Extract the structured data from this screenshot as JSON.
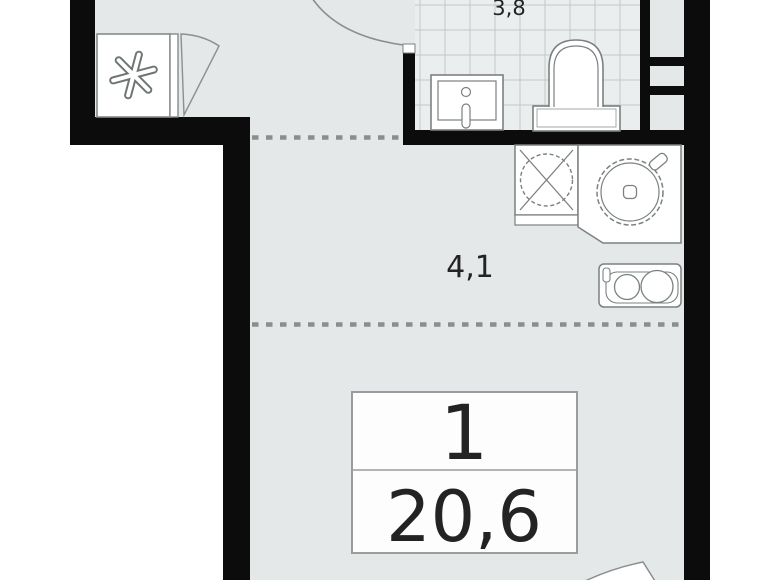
{
  "plan": {
    "bathroom": {
      "area_label": "3,8"
    },
    "hall": {
      "area_label": "4,1"
    },
    "summary": {
      "rooms_count": "1",
      "total_area": "20,6"
    },
    "icons": [
      "snowflake-icon",
      "wardrobe-door-swing-icon",
      "entry-door-swing-arc-icon",
      "bath-sink-icon",
      "toilet-icon",
      "ventilation-shaft-icon",
      "washing-machine-icon",
      "kitchen-round-sink-icon",
      "stove-two-burner-icon",
      "balcony-door-swing-arc-icon"
    ],
    "colors": {
      "outside": "#ffffff",
      "floor": "#e5e8e8",
      "tile_floor": "#ebeeee",
      "tile_grid_line": "#c3c8c7",
      "wall": "#0c0c0c",
      "fixture_outline": "#7b8080",
      "zone_dashed_line": "#898e8e",
      "info_box_border": "#9c9c9c",
      "text": "#232323"
    }
  }
}
